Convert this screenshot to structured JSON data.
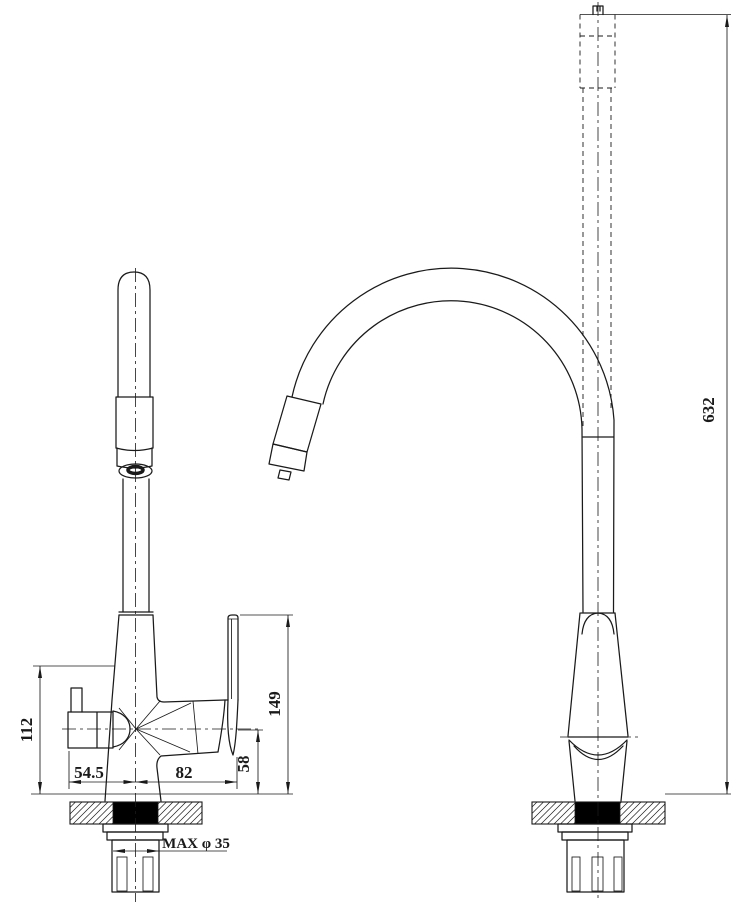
{
  "drawing": {
    "title": "Kitchen faucet two-view installation drawing",
    "views": {
      "front": "front view",
      "side": "side view"
    }
  },
  "dimensions": {
    "side_outlet_height": "112",
    "spout_offset_left": "54.5",
    "handle_offset_right": "82",
    "handle_base_height": "58",
    "handle_top_height": "149",
    "overall_height": "632",
    "mounting_hole_max": "MAX φ 35"
  },
  "colors": {
    "line": "#1a1a1a",
    "background": "#ffffff",
    "seal_fill": "#000000"
  }
}
